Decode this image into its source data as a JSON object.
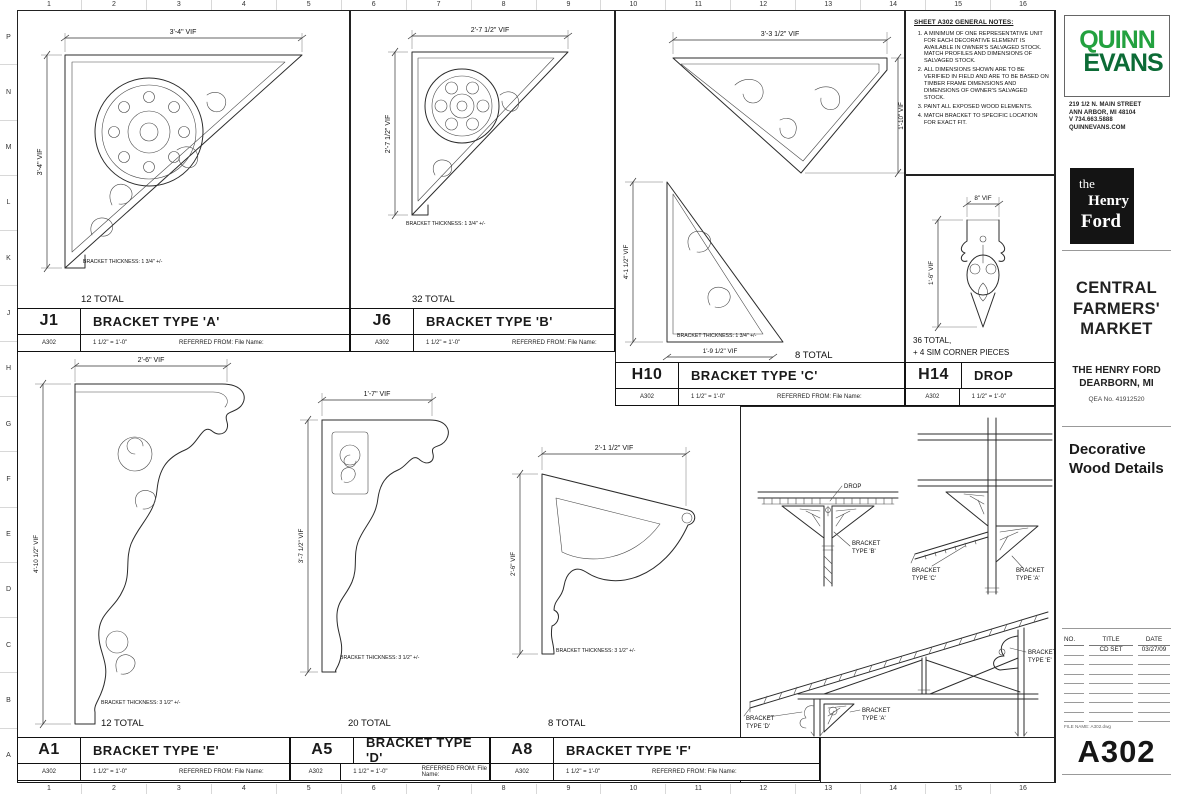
{
  "sheet": {
    "number": "A302",
    "title": "Decorative Wood Details",
    "file_label": "FILE NAME: A302.dwg"
  },
  "grid": {
    "top": [
      "1",
      "2",
      "3",
      "4",
      "5",
      "6",
      "7",
      "8",
      "9",
      "10",
      "11",
      "12",
      "13",
      "14",
      "15",
      "16"
    ],
    "bottom": [
      "1",
      "2",
      "3",
      "4",
      "5",
      "6",
      "7",
      "8",
      "9",
      "10",
      "11",
      "12",
      "13",
      "14",
      "15",
      "16"
    ],
    "left": [
      "P",
      "N",
      "M",
      "L",
      "K",
      "J",
      "H",
      "G",
      "F",
      "E",
      "D",
      "C",
      "B",
      "A"
    ]
  },
  "notes": {
    "heading": "SHEET A302 GENERAL NOTES:",
    "items": [
      "A MINIMUM OF ONE REPRESENTATIVE UNIT FOR EACH DECORATIVE ELEMENT IS AVAILABLE IN OWNER'S SALVAGED STOCK. MATCH PROFILES AND DIMENSIONS OF SALVAGED STOCK.",
      "ALL DIMENSIONS SHOWN ARE TO BE VERIFIED IN FIELD AND ARE TO BE BASED ON TIMBER FRAME DIMENSIONS AND DIMENSIONS OF OWNER'S SALVAGED STOCK.",
      "PAINT ALL EXPOSED WOOD ELEMENTS.",
      "MATCH BRACKET TO SPECIFIC LOCATION FOR EXACT FIT."
    ]
  },
  "details": {
    "a": {
      "id": "J1",
      "sheet_ref": "A302",
      "title": "BRACKET TYPE 'A'",
      "scale": "1 1/2\" = 1'-0\"",
      "referred": "REFERRED FROM: File Name:",
      "total": "12 TOTAL",
      "dim_top": "3'-4\" VIF",
      "dim_side": "3'-4\" VIF",
      "thickness": "BRACKET THICKNESS: 1 3/4\" +/-"
    },
    "b": {
      "id": "J6",
      "sheet_ref": "A302",
      "title": "BRACKET TYPE 'B'",
      "scale": "1 1/2\" = 1'-0\"",
      "referred": "REFERRED FROM: File Name:",
      "total": "32 TOTAL",
      "dim_top": "2'-7 1/2\" VIF",
      "dim_side": "2'-7 1/2\" VIF",
      "thickness": "BRACKET THICKNESS: 1 3/4\" +/-"
    },
    "c": {
      "id": "H10",
      "sheet_ref": "A302",
      "title": "BRACKET TYPE 'C'",
      "scale": "1 1/2\" = 1'-0\"",
      "referred": "REFERRED FROM: File Name:",
      "total": "8 TOTAL",
      "dim_top": "3'-3 1/2\" VIF",
      "dim_right": "1'-10\" VIF",
      "dim_side": "4'-1 1/2\" VIF",
      "dim_bottom": "1'-9 1/2\" VIF",
      "thickness": "BRACKET THICKNESS: 1 3/4\" +/-"
    },
    "drop": {
      "id": "H14",
      "sheet_ref": "A302",
      "title": "DROP",
      "scale": "1 1/2\" = 1'-0\"",
      "total_line1": "36 TOTAL,",
      "total_line2": "+ 4 SIM CORNER PIECES",
      "dim_top": "8\" VIF",
      "dim_side": "1'-6\" VIF"
    },
    "e": {
      "id": "A1",
      "sheet_ref": "A302",
      "title": "BRACKET TYPE 'E'",
      "scale": "1 1/2\" = 1'-0\"",
      "referred": "REFERRED FROM: File Name:",
      "total": "12 TOTAL",
      "dim_top": "2'-6\" VIF",
      "dim_side": "4'-10 1/2\" VIF",
      "thickness": "BRACKET THICKNESS: 3 1/2\" +/-"
    },
    "d": {
      "id": "A5",
      "sheet_ref": "A302",
      "title": "BRACKET TYPE 'D'",
      "scale": "1 1/2\" = 1'-0\"",
      "referred": "REFERRED FROM: File Name:",
      "total": "20 TOTAL",
      "dim_top": "1'-7\" VIF",
      "dim_side": "3'-7 1/2\" VIF",
      "thickness": "BRACKET THICKNESS: 3 1/2\" +/-"
    },
    "f": {
      "id": "A8",
      "sheet_ref": "A302",
      "title": "BRACKET TYPE 'F'",
      "scale": "1 1/2\" = 1'-0\"",
      "referred": "REFERRED FROM: File Name:",
      "total": "8 TOTAL",
      "dim_top": "2'-1 1/2\" VIF",
      "dim_side": "2'-6\" VIF",
      "thickness": "BRACKET THICKNESS: 3 1/2\" +/-"
    }
  },
  "sections": {
    "drop": "DROP",
    "b1": "BRACKET",
    "b2": "TYPE 'B'",
    "c1": "BRACKET",
    "c2": "TYPE 'C'",
    "a_upper1": "BRACKET",
    "a_upper2": "TYPE 'A'",
    "d1": "BRACKET",
    "d2": "TYPE 'D'",
    "a_lower1": "BRACKET",
    "a_lower2": "TYPE 'A'",
    "e1": "BRACKET",
    "e2": "TYPE 'E'"
  },
  "firm": {
    "name_line1": "QUINN",
    "name_line2": "EVANS",
    "address1": "219 1/2 N. MAIN STREET",
    "address2": "ANN ARBOR, MI 48104",
    "phone": "V 734.663.5888",
    "website": "QUINNEVANS.COM",
    "brand_green_dark": "#0c6b36",
    "brand_green_light": "#23a13f"
  },
  "client": {
    "logo_the": "the",
    "logo_henry": "Henry",
    "logo_ford": "Ford",
    "project": "CENTRAL FARMERS' MARKET",
    "owner_line1": "THE HENRY FORD",
    "owner_line2": "DEARBORN, MI",
    "job_no": "QEA No. 41912520"
  },
  "revision_table": {
    "col_no": "NO.",
    "col_title": "TITLE",
    "col_date": "DATE",
    "row_title": "CD SET",
    "row_date": "03/27/09",
    "blank_rows": 7
  }
}
